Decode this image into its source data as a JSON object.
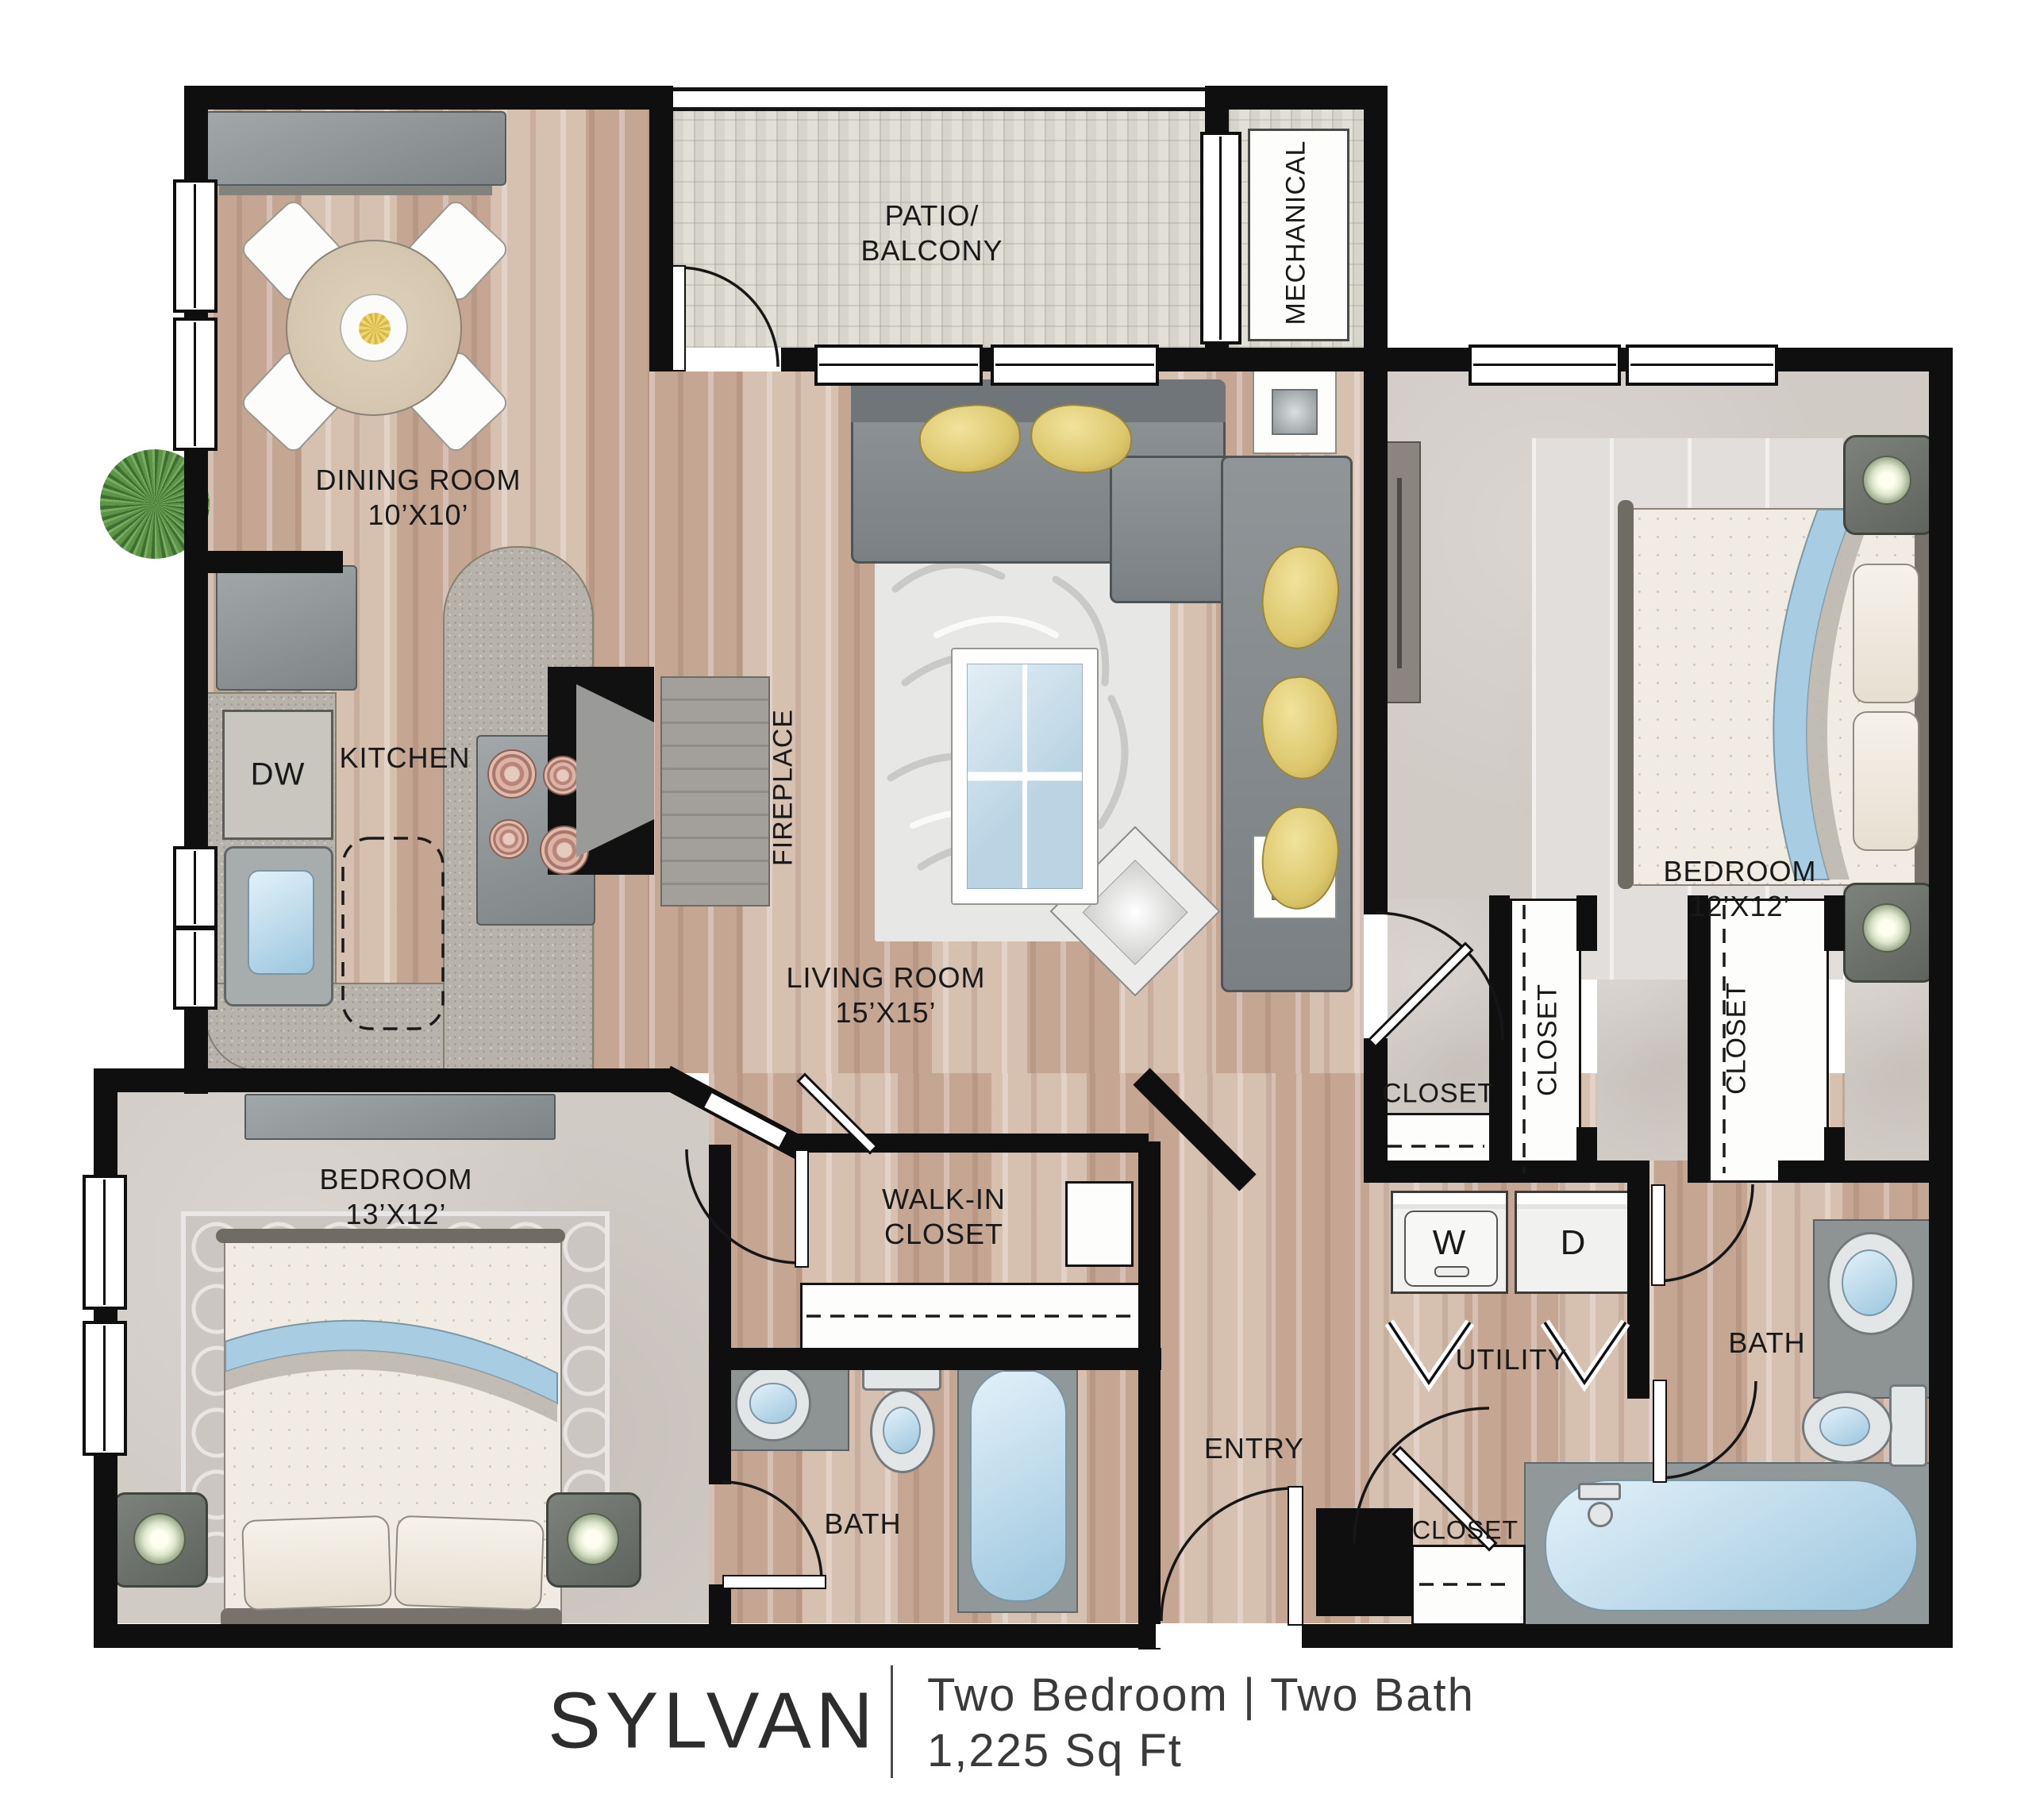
{
  "palette": {
    "wall": "#0f0f0f",
    "wood_floor": "#cdb4a3",
    "carpet": "#d1cbc6",
    "patio_tile": "#e2dfd6",
    "accent_blue": "#a8cde2",
    "accent_yellow": "#ddc86e",
    "label_text": "#191919",
    "footer_text": "#3a3a3a"
  },
  "rooms": {
    "dining": {
      "label": "DINING ROOM",
      "dims": "10’X10’"
    },
    "patio": {
      "line1": "PATIO/",
      "line2": "BALCONY"
    },
    "mechanical": {
      "label": "MECHANICAL"
    },
    "kitchen": {
      "label": "KITCHEN"
    },
    "living": {
      "label": "LIVING ROOM",
      "dims": "15’X15’"
    },
    "bedroom2": {
      "label": "BEDROOM",
      "dims": "12’X12’"
    },
    "bedroom1": {
      "label": "BEDROOM",
      "dims": "13’X12’"
    },
    "walkin": {
      "line1": "WALK-IN",
      "line2": "CLOSET"
    },
    "bath1": {
      "label": "BATH"
    },
    "bath2": {
      "label": "BATH"
    },
    "entry": {
      "label": "ENTRY"
    },
    "utility": {
      "label": "UTILITY"
    },
    "fireplace": {
      "label": "FIREPLACE"
    }
  },
  "fixtures": {
    "dishwasher": "DW",
    "washer": "W",
    "dryer": "D"
  },
  "closets": {
    "hall": "CLOSET",
    "bedroom2_a": "CLOSET",
    "bedroom2_b": "CLOSET",
    "entry": "CLOSET"
  },
  "footer": {
    "name": "SYLVAN",
    "type_line": "Two Bedroom | Two Bath",
    "area_line": "1,225 Sq Ft"
  }
}
